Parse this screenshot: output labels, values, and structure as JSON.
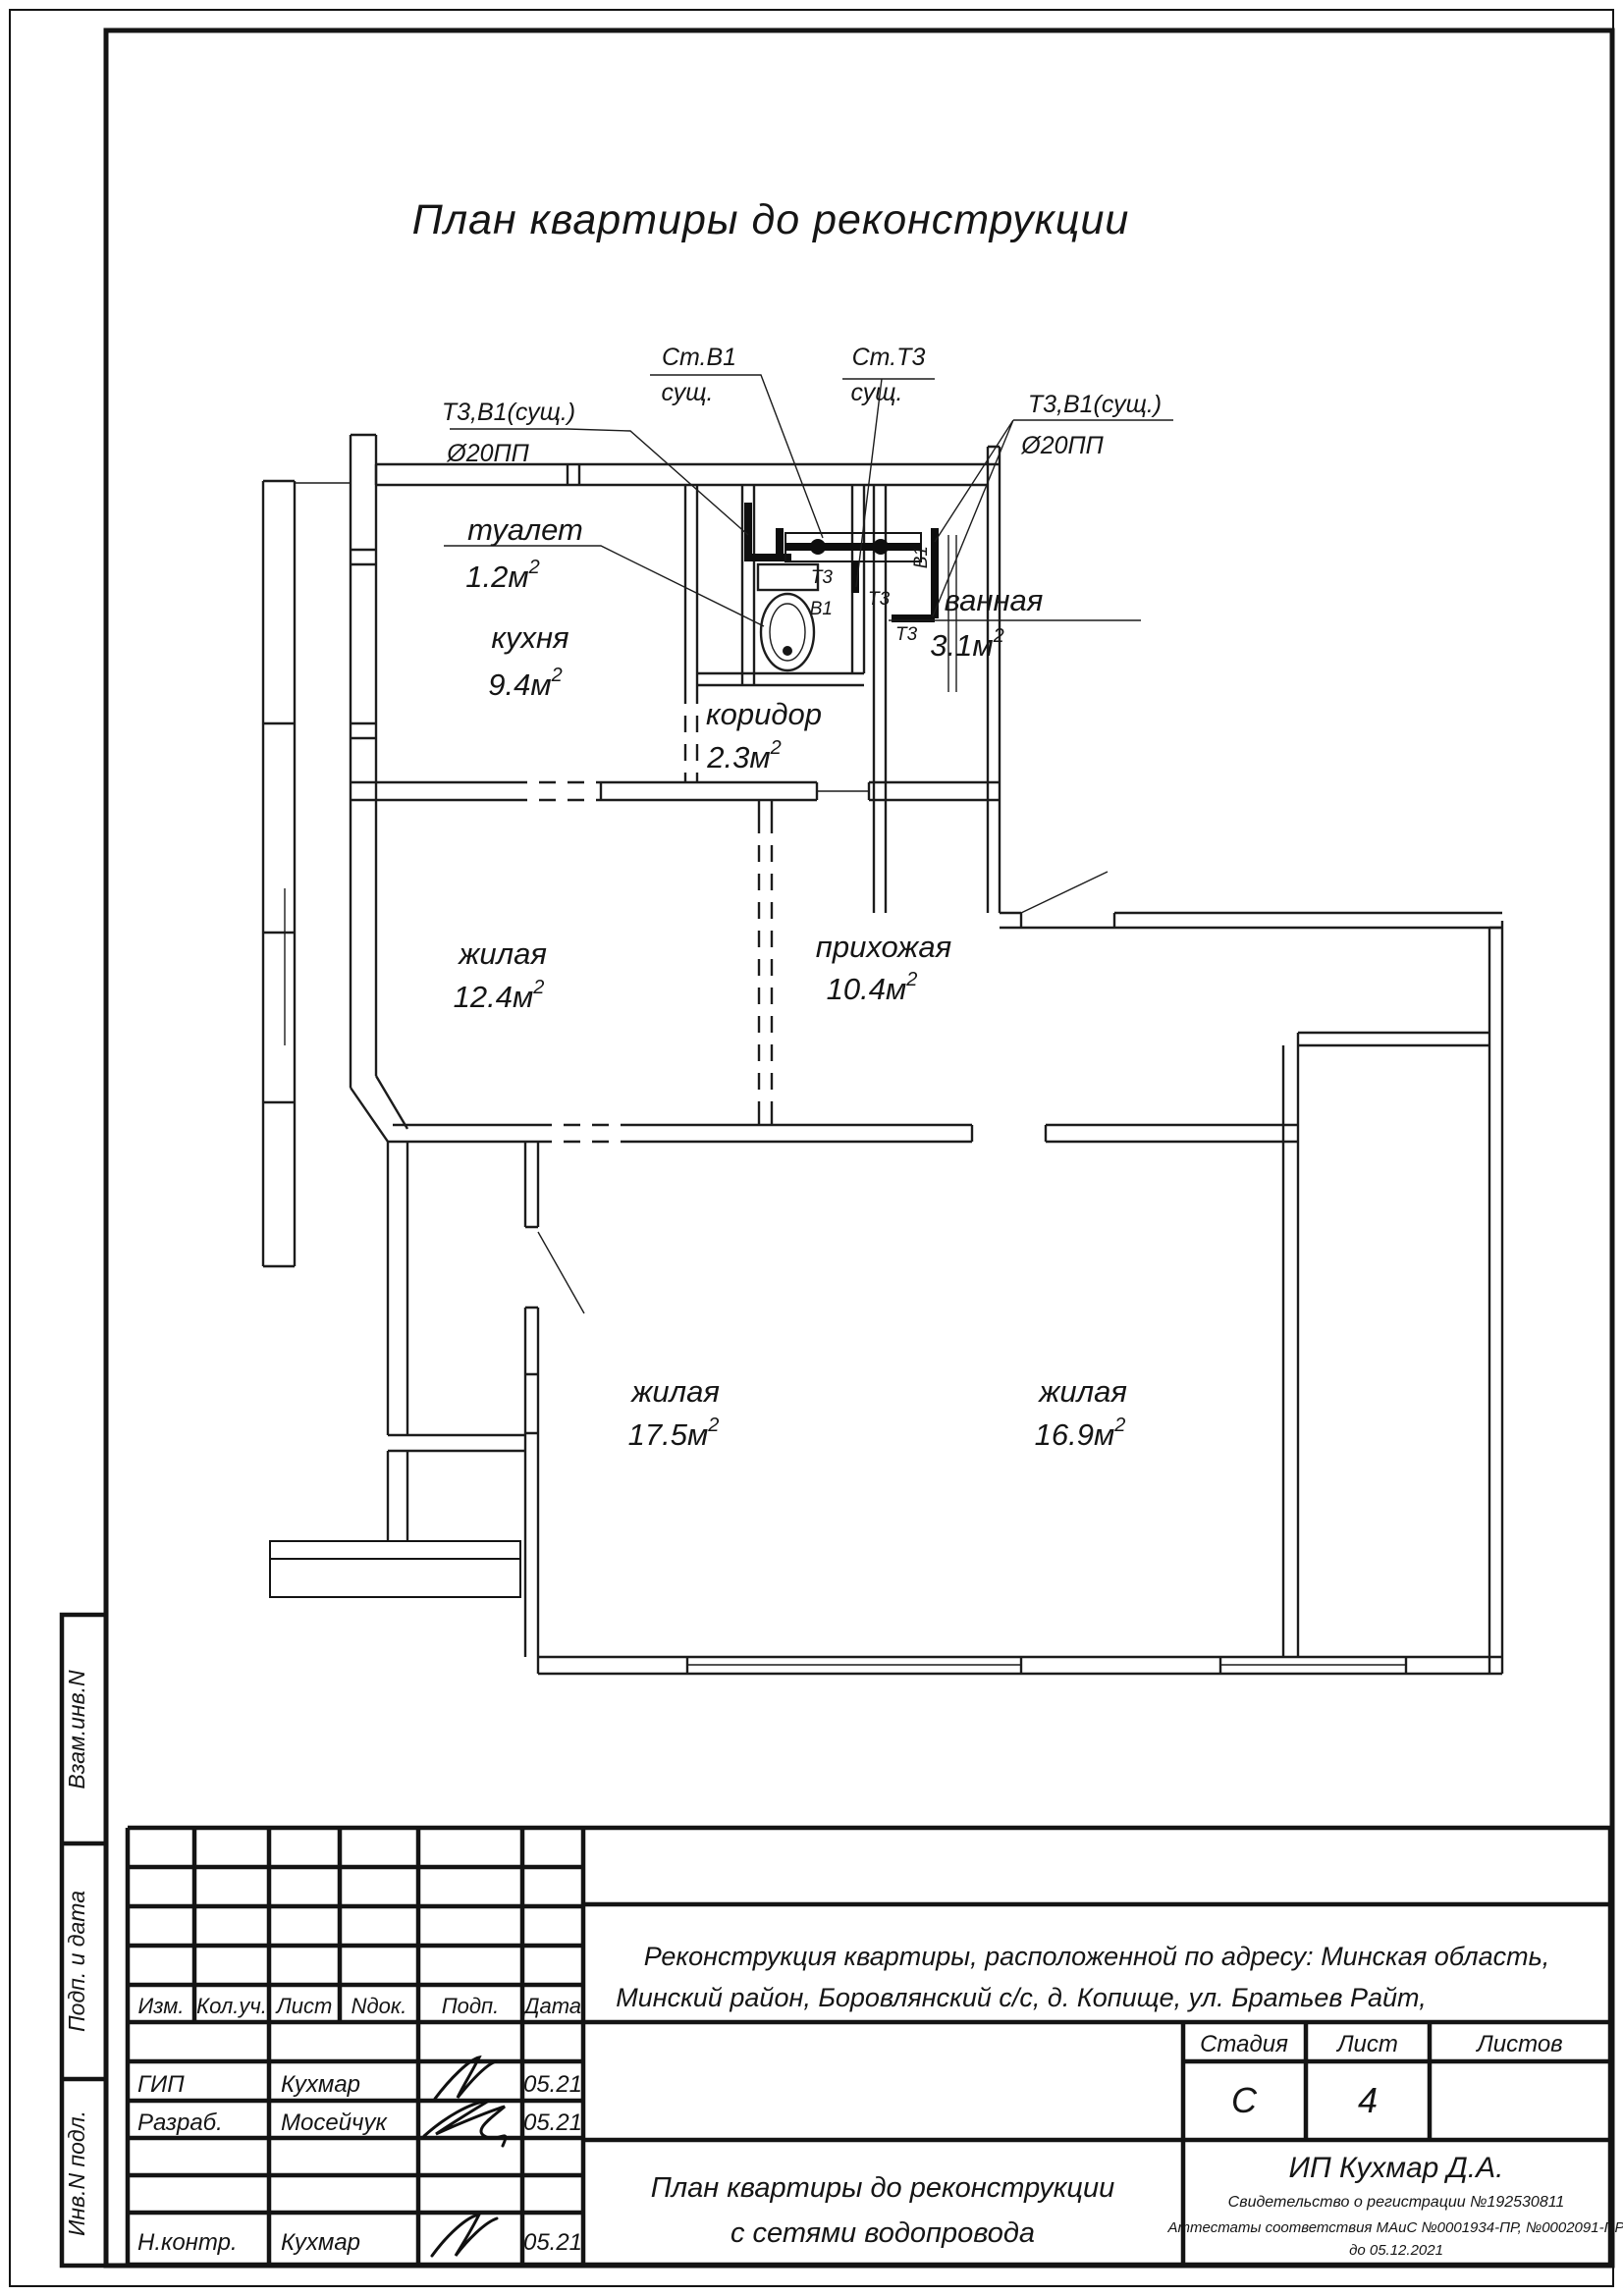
{
  "title": "План квартиры до реконструкции",
  "plan": {
    "rooms": [
      {
        "name": "туалет",
        "area": "1.2м",
        "sup": "2"
      },
      {
        "name": "кухня",
        "area": "9.4м",
        "sup": "2"
      },
      {
        "name": "ванная",
        "area": "3.1м",
        "sup": "2"
      },
      {
        "name": "коридор",
        "area": "2.3м",
        "sup": "2"
      },
      {
        "name": "жилая",
        "area": "12.4м",
        "sup": "2"
      },
      {
        "name": "прихожая",
        "area": "10.4м",
        "sup": "2"
      },
      {
        "name": "жилая",
        "area": "17.5м",
        "sup": "2"
      },
      {
        "name": "жилая",
        "area": "16.9м",
        "sup": "2"
      }
    ],
    "annotations": {
      "st_v1_line1": "Ст.В1",
      "st_v1_line2": "сущ.",
      "st_t3_line1": "Ст.Т3",
      "st_t3_line2": "сущ.",
      "t3v1_left_line1": "Т3,В1(сущ.)",
      "t3v1_left_line2": "Ø20ПП",
      "t3v1_right_line1": "Т3,В1(сущ.)",
      "t3v1_right_line2": "Ø20ПП",
      "pipe_t3_a": "Т3",
      "pipe_v1_a": "В1",
      "pipe_v1_b": "В1",
      "pipe_t3_b": "Т3",
      "pipe_t3_c": "Т3"
    }
  },
  "sidebar": {
    "cells": [
      "Взам.инв.N",
      "Подп. и дата",
      "Инв.N подл."
    ]
  },
  "titleblock": {
    "header_cols": [
      "Изм.",
      "Кол.уч.",
      "Лист",
      "Nдок.",
      "Подп.",
      "Дата"
    ],
    "rows": [
      {
        "role": "ГИП",
        "name": "Кухмар",
        "date": "05.21"
      },
      {
        "role": "Разраб.",
        "name": "Мосейчук",
        "date": "05.21"
      },
      {
        "role": "Н.контр.",
        "name": "Кухмар",
        "date": "05.21"
      }
    ],
    "address_line1": "Реконструкция квартиры, расположенной по адресу: Минская область,",
    "address_line2": "Минский район, Боровлянский с/с, д. Копище, ул. Братьев Райт,",
    "stage_label": "Стадия",
    "sheet_label": "Лист",
    "sheets_label": "Листов",
    "stage_value": "С",
    "sheet_value": "4",
    "sheets_value": "",
    "doc_line1": "План квартиры до реконструкции",
    "doc_line2": "с сетями водопровода",
    "company": "ИП Кухмар Д.А.",
    "cert_line1": "Свидетельство о регистрации №192530811",
    "cert_line2": "Аттестаты соответствия МАиС №0001934-ПР, №0002091-ПР",
    "cert_line3": "до 05.12.2021"
  }
}
